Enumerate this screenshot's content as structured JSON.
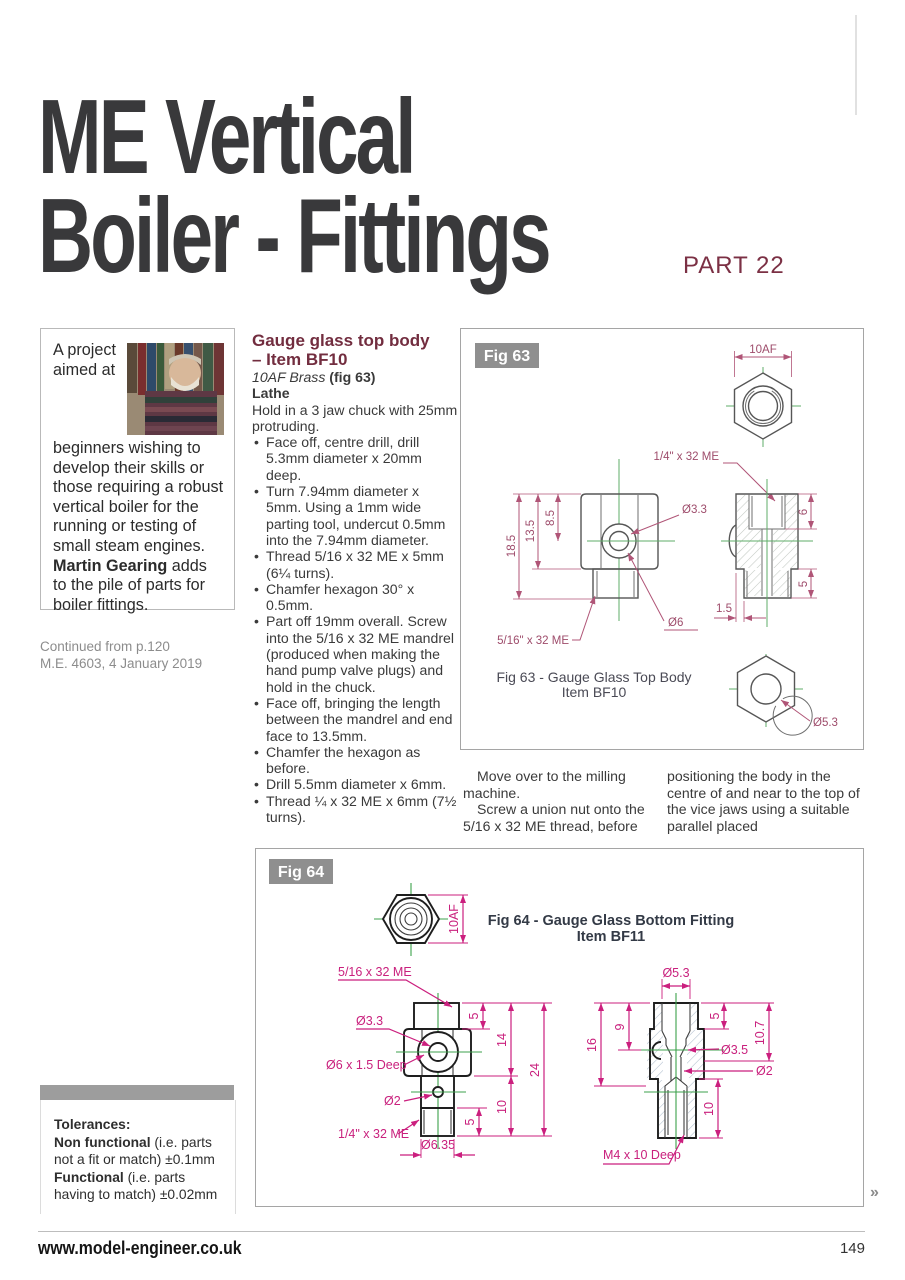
{
  "page": {
    "title_line1": "ME Vertical",
    "title_line2": "Boiler - Fittings",
    "part_label": "PART 22",
    "footer_url": "www.model-engineer.co.uk",
    "page_number": "149",
    "continued_marker": "»"
  },
  "intro_box": {
    "text_start": "A project aimed at beginners wishing to develop their skills or those requiring a robust vertical boiler for the running or testing of small steam engines. ",
    "author": "Martin Gearing",
    "text_end": " adds to the pile of parts for boiler fittings."
  },
  "continued_from": {
    "line1": "Continued from p.120",
    "line2": "M.E. 4603, 4 January 2019"
  },
  "article": {
    "heading_line1": "Gauge glass top body",
    "heading_line2": "– Item BF10",
    "material_italic": "10AF Brass ",
    "material_fig": "(fig 63)",
    "tool_label": "Lathe",
    "intro": "Hold in a 3 jaw chuck with 25mm protruding.",
    "bullets": [
      "Face off, centre drill, drill 5.3mm diameter x 20mm deep.",
      "Turn 7.94mm diameter x 5mm. Using a 1mm wide parting tool, undercut 0.5mm into the 7.94mm diameter.",
      "Thread 5/16 x 32 ME x 5mm (6¼ turns).",
      "Chamfer hexagon 30° x 0.5mm.",
      "Part off 19mm overall. Screw into the 5/16 x 32 ME mandrel (produced when making the hand pump valve plugs) and hold in the chuck.",
      "Face off, bringing the length between the mandrel and end face to 13.5mm.",
      "Chamfer the hexagon as before.",
      "Drill 5.5mm diameter x 6mm.",
      "Thread ¼ x 32 ME x 6mm (7½ turns)."
    ],
    "post_p1": "Move over to the milling machine.",
    "post_p2": "Screw a union nut onto the 5/16 x 32 ME thread, before",
    "post_p3": "positioning the body in the centre of and near to the top of the vice jaws using a suitable parallel placed"
  },
  "fig63": {
    "label": "Fig 63",
    "caption_line1": "Fig 63 - Gauge Glass Top Body",
    "caption_line2": "Item BF10",
    "ann": {
      "af": "10AF",
      "thread_top": "1/4\" x 32 ME",
      "d33": "Ø3.3",
      "h185": "18.5",
      "h135": "13.5",
      "h85": "8.5",
      "d6": "Ø6",
      "thread_bottom": "5/16\" x 32 ME",
      "h6": "6",
      "h5": "5",
      "w15": "1.5",
      "d53": "Ø5.3"
    }
  },
  "fig64": {
    "label": "Fig 64",
    "caption_line1": "Fig 64 - Gauge Glass Bottom Fitting",
    "caption_line2": "Item BF11",
    "ann": {
      "af": "10AF",
      "thread_516": "5/16 x 32 ME",
      "d33": "Ø3.3",
      "d6deep": "Ø6 x 1.5 Deep",
      "d2l": "Ø2",
      "thread_14": "1/4\" x 32 ME",
      "d635": "Ø6.35",
      "h5top": "5",
      "h14": "14",
      "h24": "24",
      "h10l": "10",
      "h5bot": "5",
      "d53": "Ø5.3",
      "h16": "16",
      "h9": "9",
      "h5r": "5",
      "h107": "10.7",
      "d35": "Ø3.5",
      "d2r": "Ø2",
      "h10r": "10",
      "m4": "M4 x 10 Deep"
    }
  },
  "tolerances": {
    "heading": "Tolerances:",
    "nf_bold": "Non functional",
    "nf_rest": " (i.e. parts not a fit or match) ±0.1mm",
    "f_bold": "Functional",
    "f_rest": " (i.e. parts having to match) ±0.02mm"
  },
  "colors": {
    "accent_maroon": "#7b3044",
    "dim_pink_fig63": "#b05577",
    "dim_magenta_fig64": "#cb1f7e",
    "centerline_green": "#4aa655",
    "fig_label_gray": "#8f8f8f"
  }
}
